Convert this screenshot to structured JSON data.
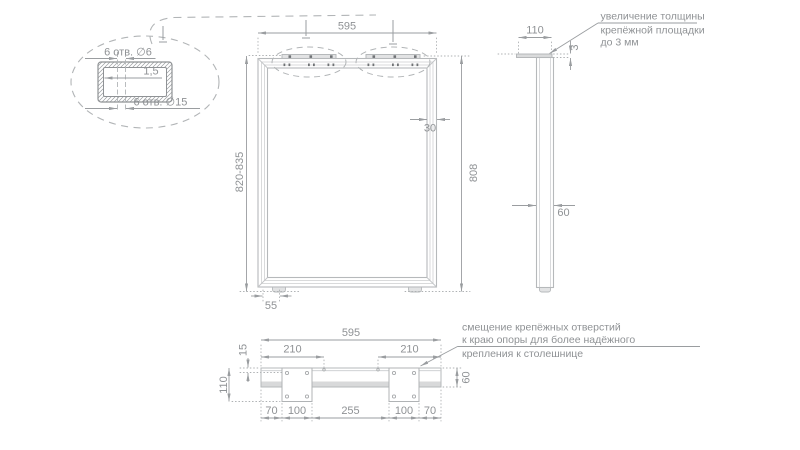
{
  "colors": {
    "contour": "#b6b9bb",
    "inner_line": "#d5d6d8",
    "dim_line": "#9a9da0",
    "dotted_line": "#aeb1b3",
    "text": "#8f9295",
    "plate_fill": "#e2e3e4",
    "band_fill": "#d8d9da",
    "hole_mark": "#6f7275"
  },
  "detail_view": {
    "holes_top_label": "6 отв. ∅6",
    "wall_label": "1,5",
    "holes_bottom_label": "6 отв. ∅15"
  },
  "front_view": {
    "width": "595",
    "height_range": "820-835",
    "height": "808",
    "profile_width": "30",
    "foot_offset": "55"
  },
  "side_view": {
    "top_plate_width": "110",
    "plate_thickness": "3",
    "leg_depth": "60"
  },
  "plan_view": {
    "width": "595",
    "left_plate_span": "210",
    "right_plate_span": "210",
    "hole_edge_offset": "15",
    "plate_depth": "110",
    "bar_depth": "60",
    "seg1": "70",
    "seg2": "100",
    "seg3": "255",
    "seg4": "100",
    "seg5": "70"
  },
  "notes": {
    "top_right": {
      "line1": "увеличение толщины",
      "line2": "крепёжной площадки",
      "line3": "до 3 мм"
    },
    "bottom_right": {
      "line1": "смещение крепёжных отверстий",
      "line2": "к краю опоры для более надёжного",
      "line3": "крепления к столешнице"
    }
  }
}
